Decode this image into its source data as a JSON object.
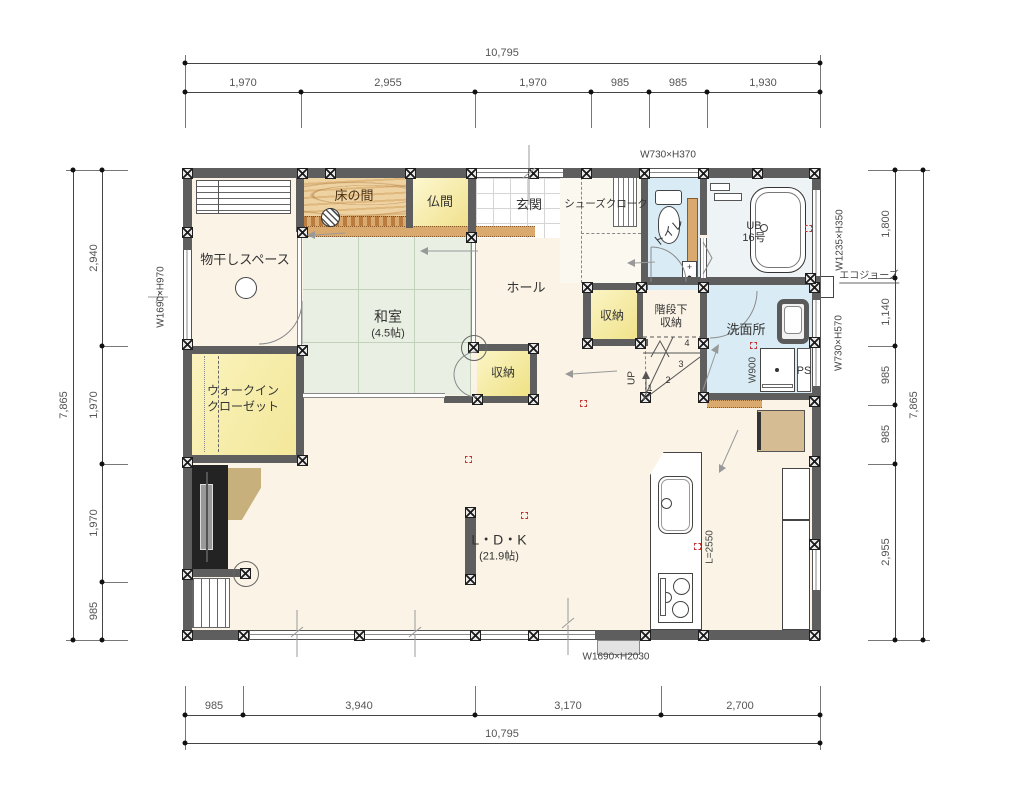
{
  "meta": {
    "kind": "japanese-house-floor-plan"
  },
  "colors": {
    "wall": "#5e5e5e",
    "floor_cream": "#faf3e6",
    "tatami_green": "#e9f0e3",
    "wet_blue": "#d9ecf5",
    "storage_yellow": "#f8f0b4",
    "wood_tan": "#e7c493",
    "threshold_tan": "#d9a96e",
    "marker_red": "#c23333"
  },
  "rooms": {
    "monohoshi": "物干しスペース",
    "tokonoma": "床の間",
    "butsuma": "仏間",
    "genkan": "玄関",
    "shoes_cloak": "シューズクローク",
    "toilet": "トイレ",
    "ub1": "UB",
    "ub2": "16号",
    "hall": "ホール",
    "washitsu": "和室",
    "washitsu_size": "(4.5帖)",
    "hall_storage": "収納",
    "under_stairs1": "階段下",
    "under_stairs2": "収納",
    "washroom": "洗面所",
    "washitsu_storage": "収納",
    "wic1": "ウォークイン",
    "wic2": "クローゼット",
    "ldk": "L・D・K",
    "ldk_size": "(21.9帖)",
    "up": "UP",
    "ps": "PS",
    "eco": "エコジョーズ"
  },
  "stairs": {
    "n1": "1",
    "n2": "2",
    "n3": "3",
    "n4": "4"
  },
  "windows": {
    "toilet_top": "W730×H370",
    "bath_right": "W1235×H350",
    "wash_right": "W730×H570",
    "left": "W1690×H970",
    "bottom": "W1690×H2030",
    "vanity": "W900",
    "kitchen": "L=2550"
  },
  "dimensions": {
    "top": {
      "total": "10,795",
      "segments": [
        "1,970",
        "2,955",
        "1,970",
        "985",
        "985",
        "1,930"
      ]
    },
    "bottom": {
      "total": "10,795",
      "segments": [
        "985",
        "3,940",
        "3,170",
        "2,700"
      ]
    },
    "left": {
      "total": "7,865",
      "segments": [
        "2,940",
        "1,970",
        "1,970",
        "985"
      ]
    },
    "right": {
      "total": "7,865",
      "segments": [
        "1,800",
        "1,140",
        "985",
        "985",
        "2,955"
      ]
    }
  }
}
